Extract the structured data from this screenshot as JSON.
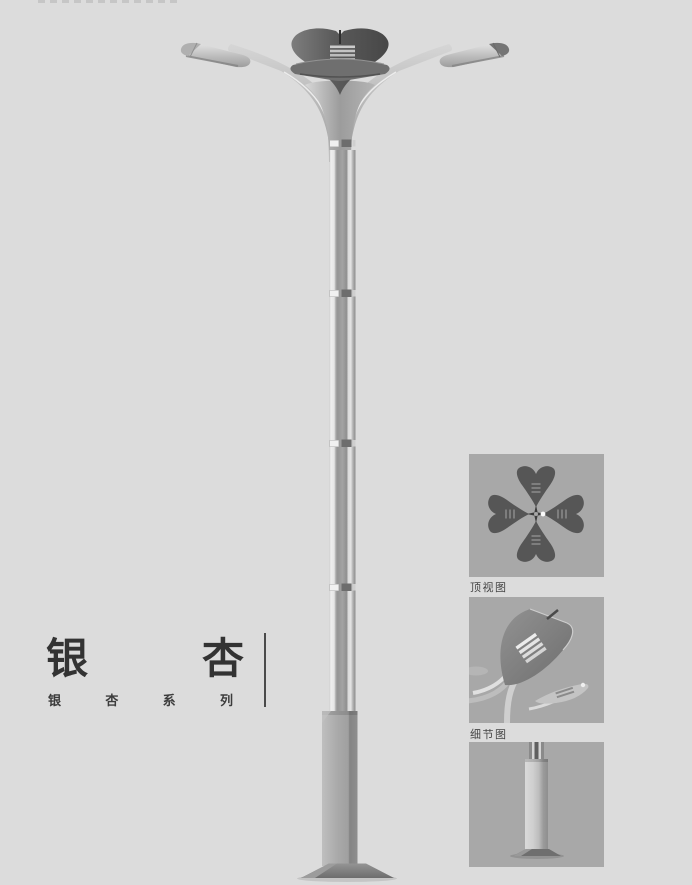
{
  "page": {
    "background": "#dcdcdc"
  },
  "title": {
    "char_1": "银",
    "char_2": "杏"
  },
  "series": {
    "char_1": "银",
    "char_2": "杏",
    "char_3": "系",
    "char_4": "列"
  },
  "thumbnails": {
    "top_view_label": "顶视图",
    "detail_view_label": "细节图"
  },
  "colors": {
    "background": "#dcdcdc",
    "thumbnail_background": "#a8a8a8",
    "metal_dark": "#575757",
    "metal_mid": "#9e9e9e",
    "metal_light": "#cfcfcf",
    "text": "#3c3c3c"
  }
}
